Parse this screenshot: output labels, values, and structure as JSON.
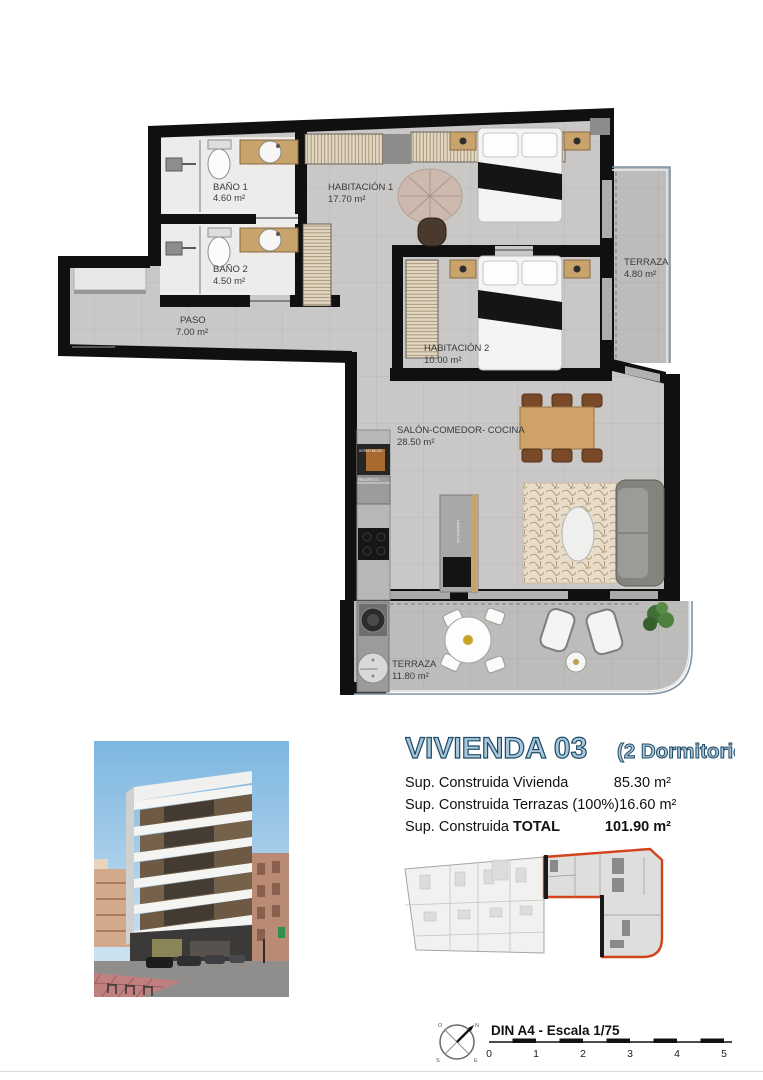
{
  "plan": {
    "rooms": [
      {
        "name": "BAÑO 1",
        "area": "4.60 m²"
      },
      {
        "name": "BAÑO 2",
        "area": "4.50 m²"
      },
      {
        "name": "HABITACIÓN 1",
        "area": "17.70 m²"
      },
      {
        "name": "HABITACIÓN 2",
        "area": "10.00 m²"
      },
      {
        "name": "PASO",
        "area": "7.00 m²"
      },
      {
        "name": "SALÓN-COMEDOR- COCINA",
        "area": "28.50 m²"
      },
      {
        "name": "TERRAZA",
        "area": "4.80 m²"
      },
      {
        "name": "TERRAZA",
        "area": "11.80 m²"
      }
    ],
    "appliances": {
      "oven": "HORNO MICRO",
      "fridge": "FRIGORÍFICO",
      "dishwasher": "LAVAVAJILLAS",
      "heater": "CALENTADOR"
    }
  },
  "header": {
    "title": "VIVIENDA 03",
    "subtitle": "(2 Dormitorios)"
  },
  "surfaces": {
    "rows": [
      {
        "label": "Sup. Construida Vivienda",
        "label_bold": "",
        "value": "85.30 m²"
      },
      {
        "label": "Sup. Construida Terrazas (100%)",
        "label_bold": "",
        "value": "16.60 m²"
      },
      {
        "label": "Sup. Construida ",
        "label_bold": "TOTAL",
        "value": "101.90 m²"
      }
    ]
  },
  "footer": {
    "scale_label": "DIN A4 - Escala 1/75",
    "ticks": [
      "0",
      "1",
      "2",
      "3",
      "4",
      "5"
    ],
    "compass": {
      "n": "N",
      "s": "S",
      "e": "E",
      "w": "O"
    }
  },
  "colors": {
    "unit_outline_red": "#d2431c",
    "title_fill": "#a9c7da",
    "title_stroke": "#1d4a66",
    "wall_black": "#101010"
  }
}
